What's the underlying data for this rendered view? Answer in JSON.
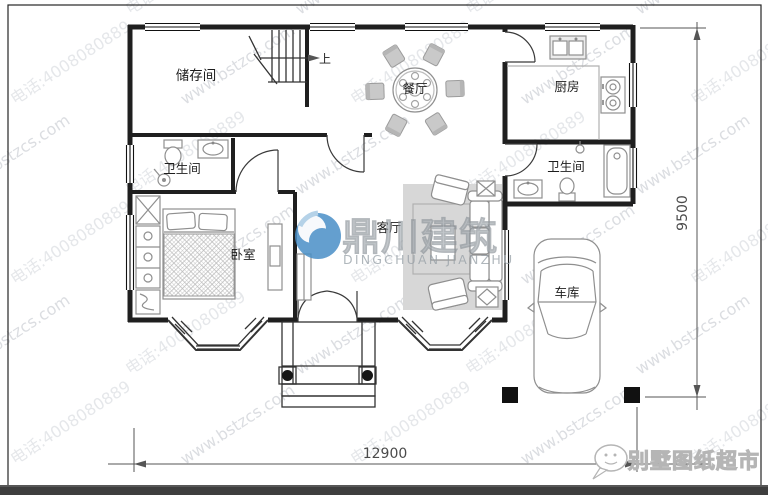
{
  "plan": {
    "rooms": [
      {
        "id": "storage",
        "label": "储存间"
      },
      {
        "id": "dining",
        "label": "餐厅"
      },
      {
        "id": "kitchen",
        "label": "厨房"
      },
      {
        "id": "bath_left",
        "label": "卫生间"
      },
      {
        "id": "bath_right",
        "label": "卫生间"
      },
      {
        "id": "bedroom",
        "label": "卧室"
      },
      {
        "id": "living",
        "label": "客厅"
      },
      {
        "id": "garage",
        "label": "车库"
      }
    ],
    "stairs_up_label": "上",
    "dimensions": {
      "bottom": "12900",
      "right": "9500"
    }
  },
  "watermark": {
    "url": "www.bstzcs.com",
    "phone": "电话:4008080889"
  },
  "brand": {
    "cn": "鼎川建筑",
    "en": "DINGCHUAN JIANZHU",
    "accent": "#4a8fc7"
  },
  "footer": {
    "shop": "别墅图纸超市"
  },
  "colors": {
    "wall": "#1f1f1f",
    "watermark_dark": "#b8bcc4",
    "watermark_light": "#ccd0d6",
    "bottom_bar": "#3e3e3e"
  }
}
